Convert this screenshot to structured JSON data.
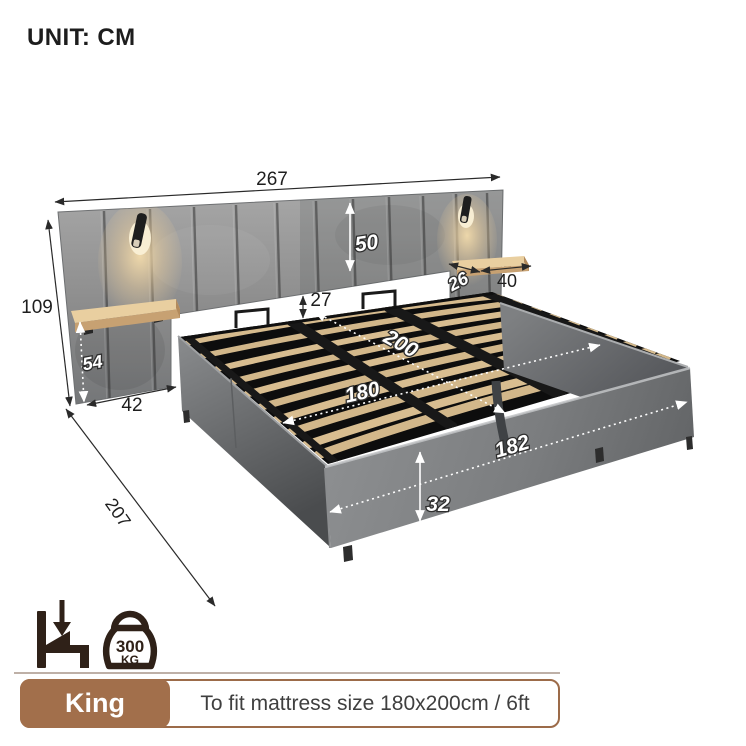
{
  "header": {
    "unit_label": "UNIT: CM"
  },
  "diagram": {
    "dims": {
      "headboard_width": "267",
      "headboard_panel_height": "50",
      "total_height": "109",
      "shelf_height_below": "54",
      "side_wing_width": "42",
      "headboard_to_base_gap": "27",
      "shelf_depth": "26",
      "shelf_width": "40",
      "slat_area_length": "200",
      "slat_area_width": "180",
      "base_outer_width": "182",
      "base_height": "32",
      "total_length": "207"
    },
    "icons": {
      "left": "bed-mattress-drop-icon",
      "right": "kettlebell-weight-icon"
    }
  },
  "capacity": {
    "value": "300",
    "unit": "KG"
  },
  "footer": {
    "size_label": "King",
    "fit_label": "To fit mattress size 180x200cm / 6ft"
  },
  "colors": {
    "accent_brown": "#a26f4b",
    "icon_dark": "#2f2118",
    "fabric_gray": "#8b8d8f",
    "wood_light": "#e9cfa0",
    "slat_wood": "#d6bb8e"
  }
}
